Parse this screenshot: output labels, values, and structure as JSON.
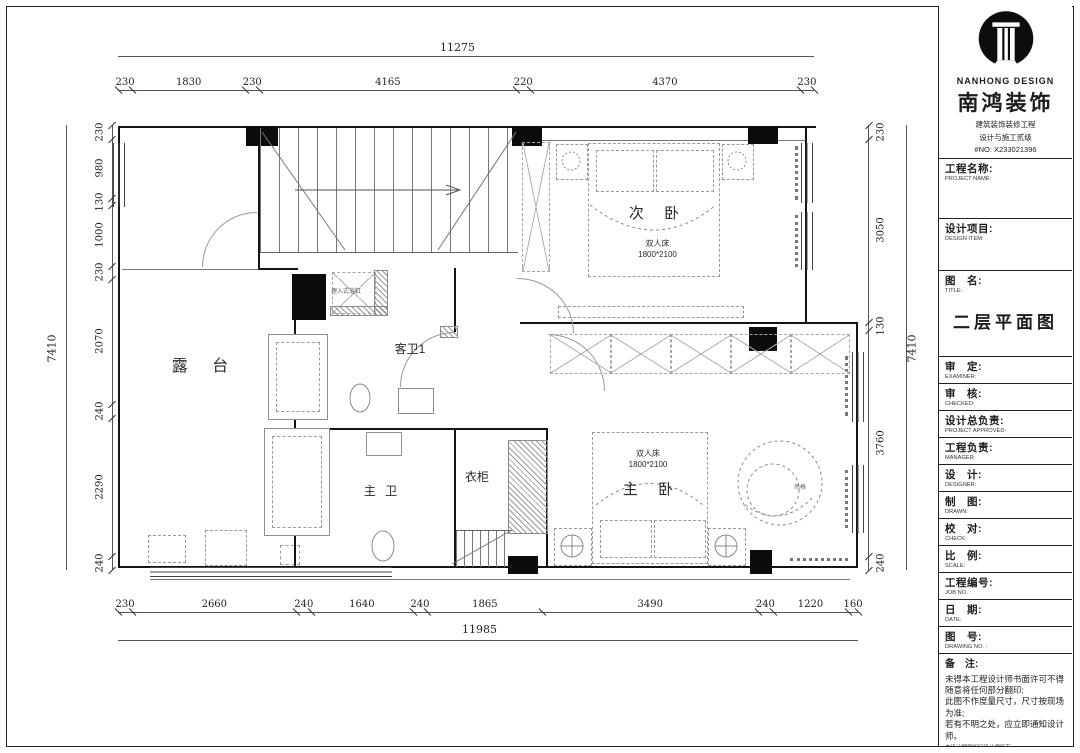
{
  "title_block": {
    "brand_en": "NANHONG DESIGN",
    "brand_cn": "南鸿装饰",
    "brand_sub1": "建筑装饰装修工程",
    "brand_sub2": "设计与施工贰级",
    "brand_license": "#NO: X233021396",
    "drawing_title": "二层平面图",
    "fields": [
      {
        "id": "project-name",
        "cn": "工程名称:",
        "en": "PROJECT NAME:",
        "tall": 1
      },
      {
        "id": "design-item",
        "cn": "设计项目:",
        "en": "DESIGN ITEM:",
        "tall": 2
      },
      {
        "id": "title",
        "cn": "图　名:",
        "en": "TITLE:",
        "title_box": true
      },
      {
        "id": "examiner",
        "cn": "审　定:",
        "en": "EXAMINER:"
      },
      {
        "id": "checked",
        "cn": "审　核:",
        "en": "CHECKED:"
      },
      {
        "id": "project-approved",
        "cn": "设计总负责:",
        "en": "PROJECT APPROVED:"
      },
      {
        "id": "manager",
        "cn": "工程负责:",
        "en": "MANAGER:"
      },
      {
        "id": "designer",
        "cn": "设　计:",
        "en": "DESIGNER:"
      },
      {
        "id": "drawn",
        "cn": "制　图:",
        "en": "DRAWN:"
      },
      {
        "id": "check",
        "cn": "校　对:",
        "en": "CHECK:"
      },
      {
        "id": "scale",
        "cn": "比　例:",
        "en": "SCALE:"
      },
      {
        "id": "job-no",
        "cn": "工程编号:",
        "en": "JOB NO. :"
      },
      {
        "id": "date",
        "cn": "日　期:",
        "en": "DATE:"
      },
      {
        "id": "drawing-no",
        "cn": "图　号:",
        "en": "DRAWING NO. :"
      }
    ],
    "notes_label": "备　注:",
    "notes": [
      "未得本工程设计师书面许可不得",
      "随意将任何部分翻印;",
      "此图不作度量尺寸，尺寸按现场",
      "为准;",
      "若有不明之处，应立即通知设计",
      "师。"
    ],
    "notes_small": "本设计解释权归设计师所有。",
    "hotline": "免费咨询电话:400.8383.168"
  },
  "plan": {
    "rooms": {
      "terrace": "露 台",
      "secondary_bedroom": "次 卧",
      "guest_bath": "客卫1",
      "master_bath": "主 卫",
      "wardrobe": "衣柜",
      "master_bedroom": "主 卧"
    },
    "labels": {
      "bed_secondary_l1": "双人床",
      "bed_secondary_l2": "1800*2100",
      "bed_master_l1": "双人床",
      "bed_master_l2": "1800*2100",
      "tub": "埋入式浴缸",
      "chair": "吊椅"
    },
    "dimensions": {
      "top": {
        "total": "11275",
        "segments": [
          230,
          1830,
          230,
          4165,
          220,
          4370,
          230
        ]
      },
      "bottom": {
        "total": "11985",
        "segments": [
          230,
          2660,
          240,
          1640,
          240,
          1865,
          3490,
          240,
          1220,
          160
        ]
      },
      "left": {
        "total": "7410",
        "segments": [
          230,
          980,
          130,
          1000,
          230,
          2070,
          240,
          2290,
          240
        ]
      },
      "right": {
        "total": "7410",
        "segments": [
          230,
          3050,
          130,
          3760,
          240
        ]
      }
    }
  }
}
